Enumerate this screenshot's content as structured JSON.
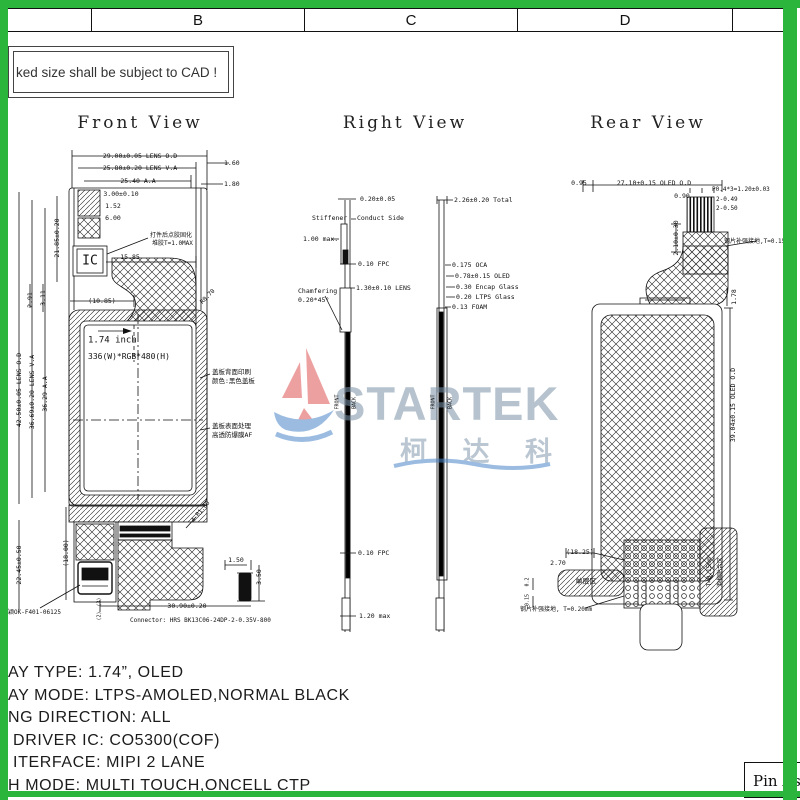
{
  "frame": {
    "green": "#2cb53c",
    "columns": [
      "B",
      "C",
      "D"
    ]
  },
  "note": {
    "text": "ked size shall be subject to CAD !"
  },
  "titles": {
    "front": "Front View",
    "right": "Right View",
    "rear": "Rear View"
  },
  "logo": {
    "brand": "STARTEK",
    "cn": "柯 达 科"
  },
  "pin_box": {
    "text": "Pin As"
  },
  "specs": [
    "AY TYPE: 1.74”, OLED",
    "AY MODE: LTPS-AMOLED,NORMAL BLACK",
    "NG DIRECTION: ALL",
    " DRIVER IC: CO5300(COF)",
    " ITERFACE: MIPI 2 LANE",
    "H MODE: MULTI TOUCH,ONCELL CTP"
  ],
  "annotations": {
    "front": [
      {
        "t": "29.00±0.05 LENS O.D",
        "x": 140,
        "y": 156
      },
      {
        "t": "25.80±0.20 LENS V.A",
        "x": 140,
        "y": 168
      },
      {
        "t": "25.40 A.A",
        "x": 138,
        "y": 181
      },
      {
        "t": "1.60",
        "x": 224,
        "y": 163,
        "a": "l"
      },
      {
        "t": "1.80",
        "x": 224,
        "y": 184,
        "a": "l"
      },
      {
        "t": "3.00±0.10",
        "x": 121,
        "y": 194
      },
      {
        "t": "1.52",
        "x": 113,
        "y": 206
      },
      {
        "t": "6.00",
        "x": 113,
        "y": 218
      },
      {
        "t": "打件后点胶固化",
        "x": 150,
        "y": 236,
        "a": "l",
        "fs": 6
      },
      {
        "t": "堆胶T=1.0MAX",
        "x": 152,
        "y": 244,
        "a": "l",
        "fs": 6
      },
      {
        "t": "IC",
        "x": 90,
        "y": 261,
        "fs": 13
      },
      {
        "t": "15.85",
        "x": 130,
        "y": 257
      },
      {
        "t": "(10.85)",
        "x": 102,
        "y": 301
      },
      {
        "t": "21.85±0.20",
        "x": 57,
        "y": 238,
        "r": -90
      },
      {
        "t": "2.91",
        "x": 30,
        "y": 300,
        "r": -90
      },
      {
        "t": "3.11",
        "x": 43,
        "y": 298,
        "r": -90
      },
      {
        "t": "42.50±0.05 LENS O.D",
        "x": 19,
        "y": 390,
        "r": -90
      },
      {
        "t": "36.69±0.20 LENS V.A",
        "x": 32,
        "y": 392,
        "r": -90
      },
      {
        "t": "36.29 A.A",
        "x": 45,
        "y": 394,
        "r": -90
      },
      {
        "t": "R0.70",
        "x": 208,
        "y": 297,
        "r": -45,
        "fs": 6
      },
      {
        "t": "1.74 inch",
        "x": 88,
        "y": 341,
        "a": "l",
        "fs": 9
      },
      {
        "t": "336(W)*RGB*480(H)",
        "x": 88,
        "y": 357,
        "a": "l",
        "fs": 8
      },
      {
        "t": "盖板背面印刷",
        "x": 212,
        "y": 372,
        "a": "l",
        "fs": 6.5
      },
      {
        "t": "颜色:黑色盖板",
        "x": 212,
        "y": 381,
        "a": "l",
        "fs": 6.5
      },
      {
        "t": "盖板表面处理",
        "x": 212,
        "y": 426,
        "a": "l",
        "fs": 6.5
      },
      {
        "t": "高透防爆膜AF",
        "x": 212,
        "y": 435,
        "a": "l",
        "fs": 6.5
      },
      {
        "t": "22.45±0.50",
        "x": 19,
        "y": 565,
        "r": -90
      },
      {
        "t": "(18.00)",
        "x": 66,
        "y": 553,
        "r": -90
      },
      {
        "t": "4-R1.00",
        "x": 201,
        "y": 512,
        "r": -50,
        "fs": 6
      },
      {
        "t": "1.50",
        "x": 236,
        "y": 560
      },
      {
        "t": "3.50",
        "x": 259,
        "y": 577,
        "r": -90
      },
      {
        "t": "(3)",
        "x": 100,
        "y": 602,
        "r": -90,
        "fs": 5
      },
      {
        "t": "(2)",
        "x": 100,
        "y": 616,
        "r": -90,
        "fs": 5
      },
      {
        "t": "30.90±0.20",
        "x": 187,
        "y": 606
      },
      {
        "t": "Connector: HRS BK13C06-24DP-2-0.35V-800",
        "x": 130,
        "y": 621,
        "a": "l",
        "fs": 6
      },
      {
        "t": "东颖OK-F401-06125",
        "x": 2,
        "y": 613,
        "a": "l",
        "fs": 6
      }
    ],
    "right": [
      {
        "t": "0.20±0.05",
        "x": 360,
        "y": 199,
        "a": "l"
      },
      {
        "t": "Stiffener",
        "x": 312,
        "y": 218,
        "a": "l"
      },
      {
        "t": "Conduct Side",
        "x": 357,
        "y": 218,
        "a": "l"
      },
      {
        "t": "1.00 max.",
        "x": 303,
        "y": 239,
        "a": "l"
      },
      {
        "t": "0.10 FPC",
        "x": 358,
        "y": 264,
        "a": "l"
      },
      {
        "t": "Chamfering",
        "x": 298,
        "y": 291,
        "a": "l"
      },
      {
        "t": "0.20*45°",
        "x": 298,
        "y": 300,
        "a": "l"
      },
      {
        "t": "1.30±0.10 LENS",
        "x": 356,
        "y": 288,
        "a": "l"
      },
      {
        "t": "FRONT",
        "x": 338,
        "y": 402,
        "r": -90,
        "fs": 5
      },
      {
        "t": "BACK",
        "x": 355,
        "y": 403,
        "r": -90,
        "fs": 5
      },
      {
        "t": "0.10 FPC",
        "x": 358,
        "y": 553,
        "a": "l"
      },
      {
        "t": "1.20 max",
        "x": 359,
        "y": 616,
        "a": "l"
      },
      {
        "t": "2.26±0.20 Total",
        "x": 454,
        "y": 200,
        "a": "l"
      },
      {
        "t": "0.175 OCA",
        "x": 452,
        "y": 265,
        "a": "l"
      },
      {
        "t": "0.78±0.15 OLED",
        "x": 455,
        "y": 276,
        "a": "l"
      },
      {
        "t": "0.30 Encap Glass",
        "x": 456,
        "y": 287,
        "a": "l"
      },
      {
        "t": "0.20 LTPS Glass",
        "x": 456,
        "y": 297,
        "a": "l"
      },
      {
        "t": "0.13 FOAM",
        "x": 452,
        "y": 307,
        "a": "l"
      },
      {
        "t": "FRONT",
        "x": 434,
        "y": 402,
        "r": -90,
        "fs": 5
      },
      {
        "t": "BACK",
        "x": 451,
        "y": 403,
        "r": -90,
        "fs": 5
      }
    ],
    "rear": [
      {
        "t": "0.95",
        "x": 579,
        "y": 183
      },
      {
        "t": "27.10±0.15 OLED O.D",
        "x": 654,
        "y": 183
      },
      {
        "t": "P0.4*3=1.20±0.03",
        "x": 712,
        "y": 190,
        "a": "l",
        "fs": 6
      },
      {
        "t": "0.90",
        "x": 682,
        "y": 196
      },
      {
        "t": "2-0.49",
        "x": 716,
        "y": 200,
        "a": "l",
        "fs": 6
      },
      {
        "t": "2-0.50",
        "x": 716,
        "y": 209,
        "a": "l",
        "fs": 6
      },
      {
        "t": "2.10±0.30",
        "x": 676,
        "y": 238,
        "r": -90
      },
      {
        "t": "钢片补强接地,T=0.15mm",
        "x": 724,
        "y": 242,
        "a": "l",
        "fs": 6
      },
      {
        "t": "1.78",
        "x": 734,
        "y": 297,
        "r": -90
      },
      {
        "t": "39.04±0.15 OLED O.D",
        "x": 733,
        "y": 405,
        "r": -90
      },
      {
        "t": "(18.25)",
        "x": 580,
        "y": 552
      },
      {
        "t": "2.70",
        "x": 558,
        "y": 563
      },
      {
        "t": "单层区",
        "x": 586,
        "y": 582,
        "fs": 7
      },
      {
        "t": "泡棉贴合区",
        "x": 721,
        "y": 572,
        "r": -90,
        "fs": 6
      },
      {
        "t": "T=0.15mm",
        "x": 710,
        "y": 572,
        "r": -90,
        "fs": 6
      },
      {
        "t": "钢片补强接地, T=0.20mm",
        "x": 520,
        "y": 610,
        "a": "l",
        "fs": 6
      },
      {
        "t": "0.2",
        "x": 528,
        "y": 582,
        "r": -90,
        "fs": 5
      },
      {
        "t": "0.15",
        "x": 528,
        "y": 600,
        "r": -90,
        "fs": 5
      }
    ]
  }
}
